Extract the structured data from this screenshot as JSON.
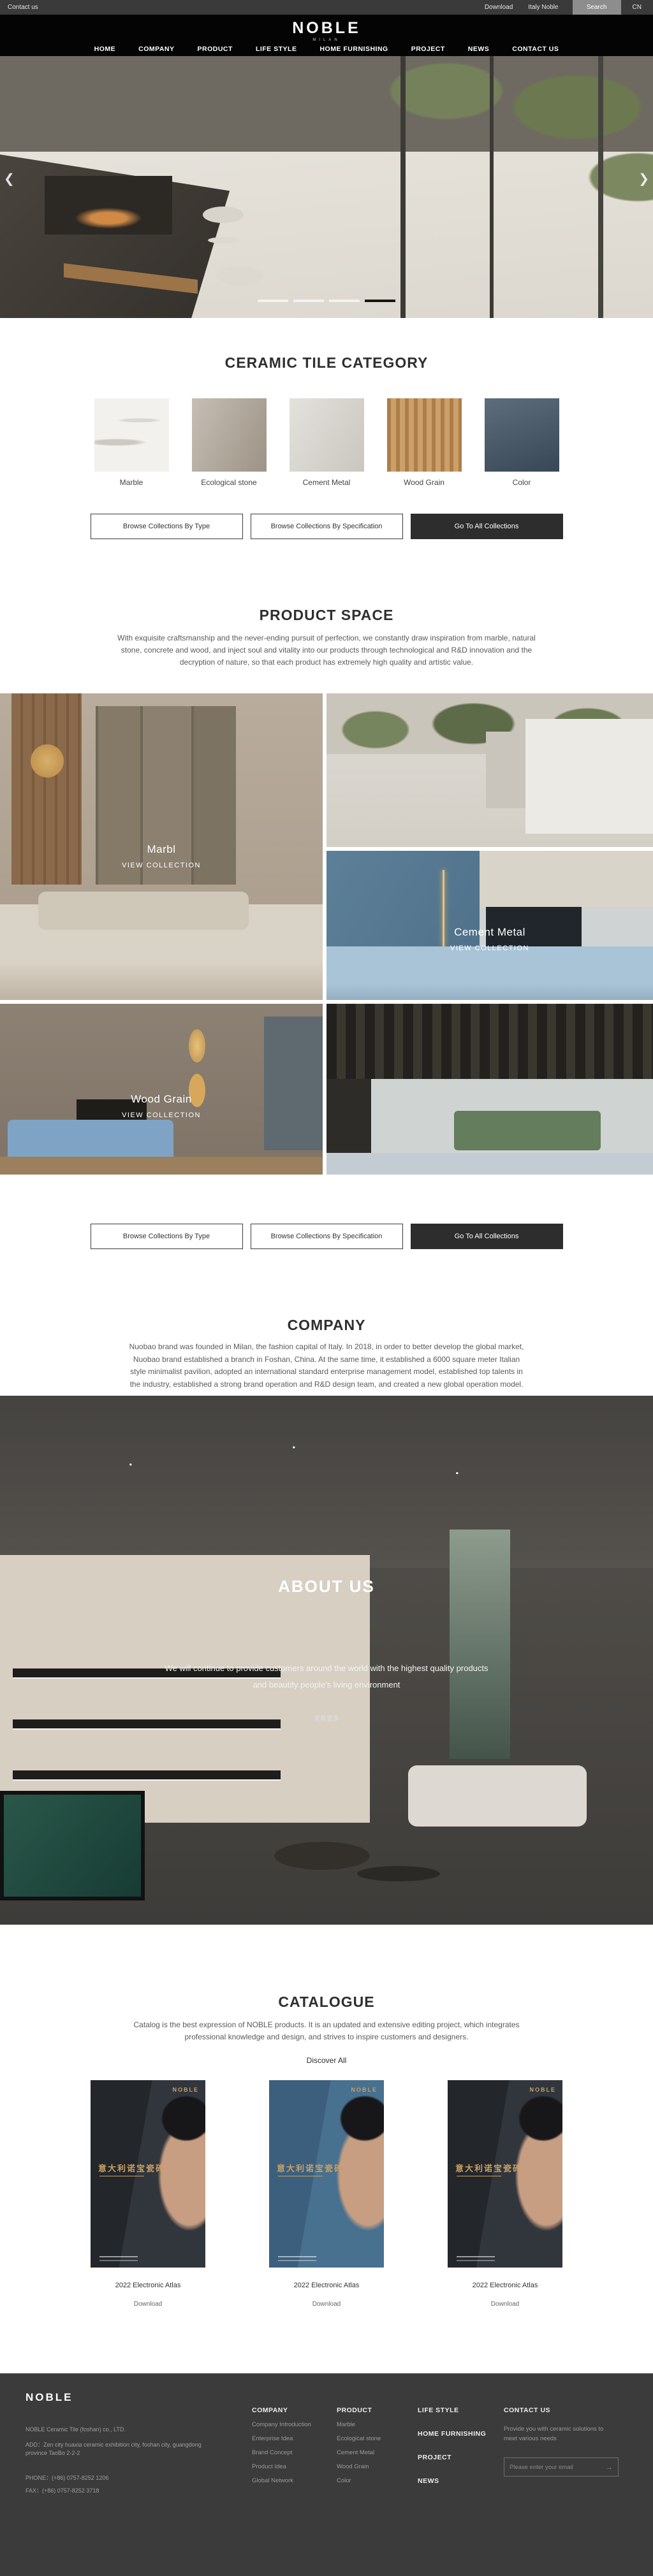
{
  "topbar": {
    "contact": "Contact us",
    "download": "Download",
    "italy_noble": "Italy Noble",
    "search": "Search",
    "lang": "CN"
  },
  "header": {
    "logo": "NOBLE",
    "logo_sub": "MILAN",
    "nav": [
      "HOME",
      "COMPANY",
      "PRODUCT",
      "LIFE STYLE",
      "HOME FURNISHING",
      "PROJECT",
      "NEWS",
      "CONTACT US"
    ]
  },
  "hero": {
    "prev": "❮",
    "next": "❯"
  },
  "category": {
    "title": "CERAMIC TILE CATEGORY",
    "tiles": [
      {
        "label": "Marble",
        "color": "#f2f1ee"
      },
      {
        "label": "Ecological stone",
        "color": "#b3a99b"
      },
      {
        "label": "Cement Metal",
        "color": "#d8d5ce"
      },
      {
        "label": "Wood Grain",
        "color": "#c0905a"
      },
      {
        "label": "Color",
        "color": "#46596a"
      }
    ],
    "buttons": {
      "by_type": "Browse Collections By Type",
      "by_spec": "Browse Collections By Specification",
      "all": "Go To All Collections"
    }
  },
  "product_space": {
    "title": "PRODUCT SPACE",
    "paragraph": "With exquisite craftsmanship and the never-ending pursuit of perfection, we constantly draw inspiration from marble, natural stone, concrete and wood, and inject soul and vitality into our products through technological and R&D innovation and the decryption of nature, so that each product has extremely high quality and artistic value.",
    "collections": [
      {
        "label": "Marbl",
        "cta": "VIEW COLLECTION"
      },
      {
        "label": "Cement Metal",
        "cta": "VIEW COLLECTION"
      },
      {
        "label": "Wood Grain",
        "cta": "VIEW COLLECTION"
      }
    ]
  },
  "company": {
    "title": "COMPANY",
    "paragraph": "Nuobao brand was founded in Milan, the fashion capital of Italy. In 2018, in order to better develop the global market, Nuobao brand established a branch in Foshan, China. At the same time, it established a 6000 square meter Italian style minimalist pavilion, adopted an international standard enterprise management model, established top talents in the industry, established a strong brand operation and R&D design team, and created a new global operation model."
  },
  "about": {
    "title": "ABOUT US",
    "line1": "We will continue to provide customers around the world with the highest quality products",
    "line2": "and beautify people's living environment",
    "more": "查看更多"
  },
  "catalogue": {
    "title": "CATALOGUE",
    "paragraph": "Catalog is the best expression of NOBLE products. It is an updated and extensive editing project, which integrates professional knowledge and design, and strives to inspire customers and designers.",
    "discover": "Discover All",
    "covers": [
      {
        "brand": "NOBLE",
        "title_cn": "意大利诺宝瓷砖",
        "label": "2022 Electronic Atlas",
        "download": "Download"
      },
      {
        "brand": "NOBLE",
        "title_cn": "意大利诺宝瓷砖",
        "label": "2022 Electronic Atlas",
        "download": "Download"
      },
      {
        "brand": "NOBLE",
        "title_cn": "意大利诺宝瓷砖",
        "label": "2022 Electronic Atlas",
        "download": "Download"
      }
    ]
  },
  "footer": {
    "logo": "NOBLE",
    "company_name": "NOBLE Ceramic Tile (foshan) co., LTD.",
    "address": "ADD：Zen city huaxia ceramic exhibition city, foshan city, guangdong province TaoBo 2-2-2",
    "phone": "PHONE：(+86) 0757-8252 1206",
    "fax": "FAX：(+86) 0757-8252 3718",
    "columns": [
      {
        "heading": "COMPANY",
        "items": [
          "Company Introduction",
          "Enterprise Idea",
          "Brand Concept",
          "Product Idea",
          "Global Network"
        ]
      },
      {
        "heading": "PRODUCT",
        "items": [
          "Marble",
          "Ecological stone",
          "Cement Metal",
          "Wood Grain",
          "Color"
        ]
      }
    ],
    "links": [
      "LIFE STYLE",
      "HOME FURNISHING",
      "PROJECT",
      "NEWS"
    ],
    "contact": {
      "heading": "CONTACT US",
      "desc": "Provide you with ceramic solutions to meet various needs",
      "placeholder": "Please enter your email"
    }
  },
  "colors": {
    "topbar_bg": "#3a3a3a",
    "header_bg": "#040404",
    "footer_bg": "#3b3b3b",
    "dark_button_bg": "#2d2d2d",
    "accent_gold": "#c9a063",
    "title_text": "#2f2f2f",
    "body_text": "#5a5a5a"
  }
}
